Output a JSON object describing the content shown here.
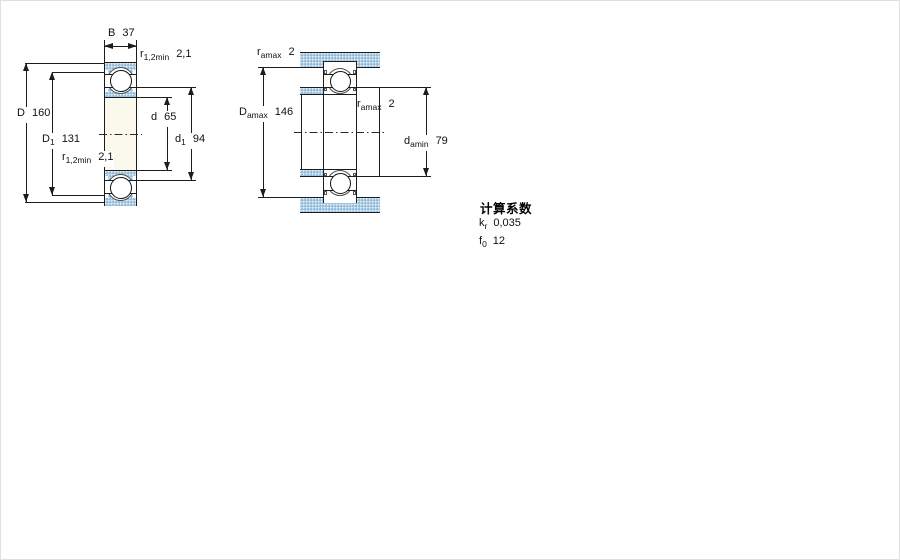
{
  "drawing_title": "bearing technical drawing",
  "left": {
    "name": "bearing cross-section diagram",
    "labels": {
      "B": {
        "sym": "B",
        "sub": "",
        "val": "37"
      },
      "r_top": {
        "sym": "r",
        "sub": "1,2min",
        "val": "2,1"
      },
      "D": {
        "sym": "D",
        "sub": "",
        "val": "160"
      },
      "D1": {
        "sym": "D",
        "sub": "1",
        "val": "131"
      },
      "d": {
        "sym": "d",
        "sub": "",
        "val": "65"
      },
      "d1": {
        "sym": "d",
        "sub": "1",
        "val": "94"
      },
      "r_bot": {
        "sym": "r",
        "sub": "1,2min",
        "val": "2,1"
      }
    }
  },
  "right": {
    "name": "abutment and fillet dimensions diagram",
    "labels": {
      "ra_top": {
        "sym": "r",
        "sub": "amax",
        "val": "2"
      },
      "Da": {
        "sym": "D",
        "sub": "amax",
        "val": "146"
      },
      "ra_mid": {
        "sym": "r",
        "sub": "amax",
        "val": "2"
      },
      "da": {
        "sym": "d",
        "sub": "amin",
        "val": "79"
      }
    }
  },
  "calc": {
    "title": "计算系数",
    "rows": [
      {
        "sym": "k",
        "sub": "r",
        "val": "0,035"
      },
      {
        "sym": "f",
        "sub": "0",
        "val": "12"
      }
    ]
  },
  "colors": {
    "hatch_blue": "#a9cbe3",
    "line": "#1c1c1c",
    "bearing_bore_fill": "#faf9ec",
    "background": "#ffffff"
  }
}
